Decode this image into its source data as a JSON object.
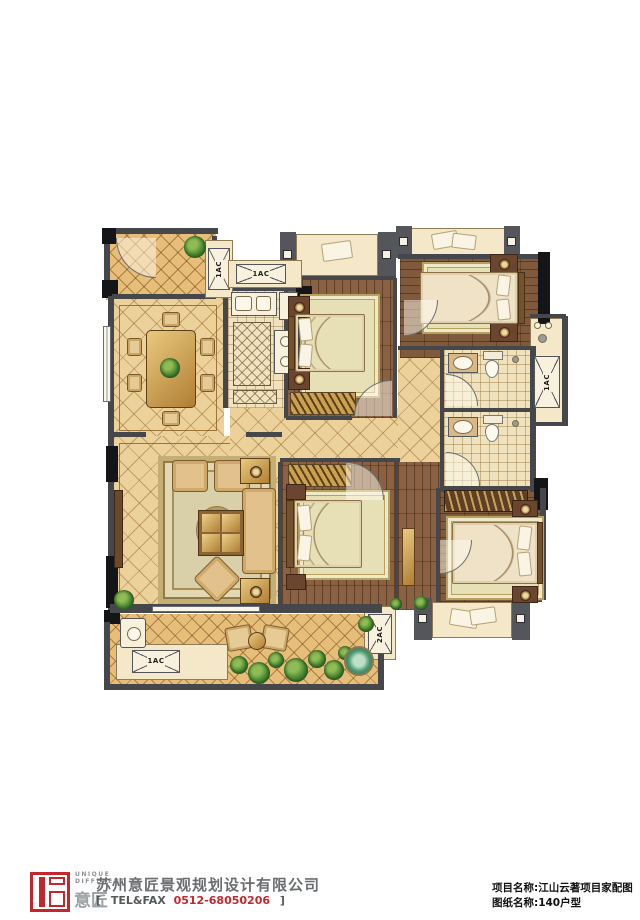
{
  "plan": {
    "ac_labels": {
      "entry": "1AC",
      "kitchen": "1AC",
      "utility": "1AC",
      "terrace": "1AC",
      "south": "2AC"
    },
    "colors": {
      "wall": "#46474b",
      "tile": "#ecd29a",
      "terrace_tile": "#e6bd79",
      "wood": "#8a6243",
      "cream": "#f4e8c8",
      "accent_red": "#c1272d"
    }
  },
  "footer": {
    "logo_top": "UNIQUE",
    "logo_bottom": "DIFFERENT",
    "logo_mark": "意匠",
    "company": "苏州意匠景观规划设计有限公司",
    "tel_open": "[",
    "tel_label": "TEL&FAX",
    "tel_number": "0512-68050206",
    "tel_close": "]",
    "project_line": "项目名称:江山云著项目家配图",
    "sheet_line": "图纸名称:140户型"
  }
}
